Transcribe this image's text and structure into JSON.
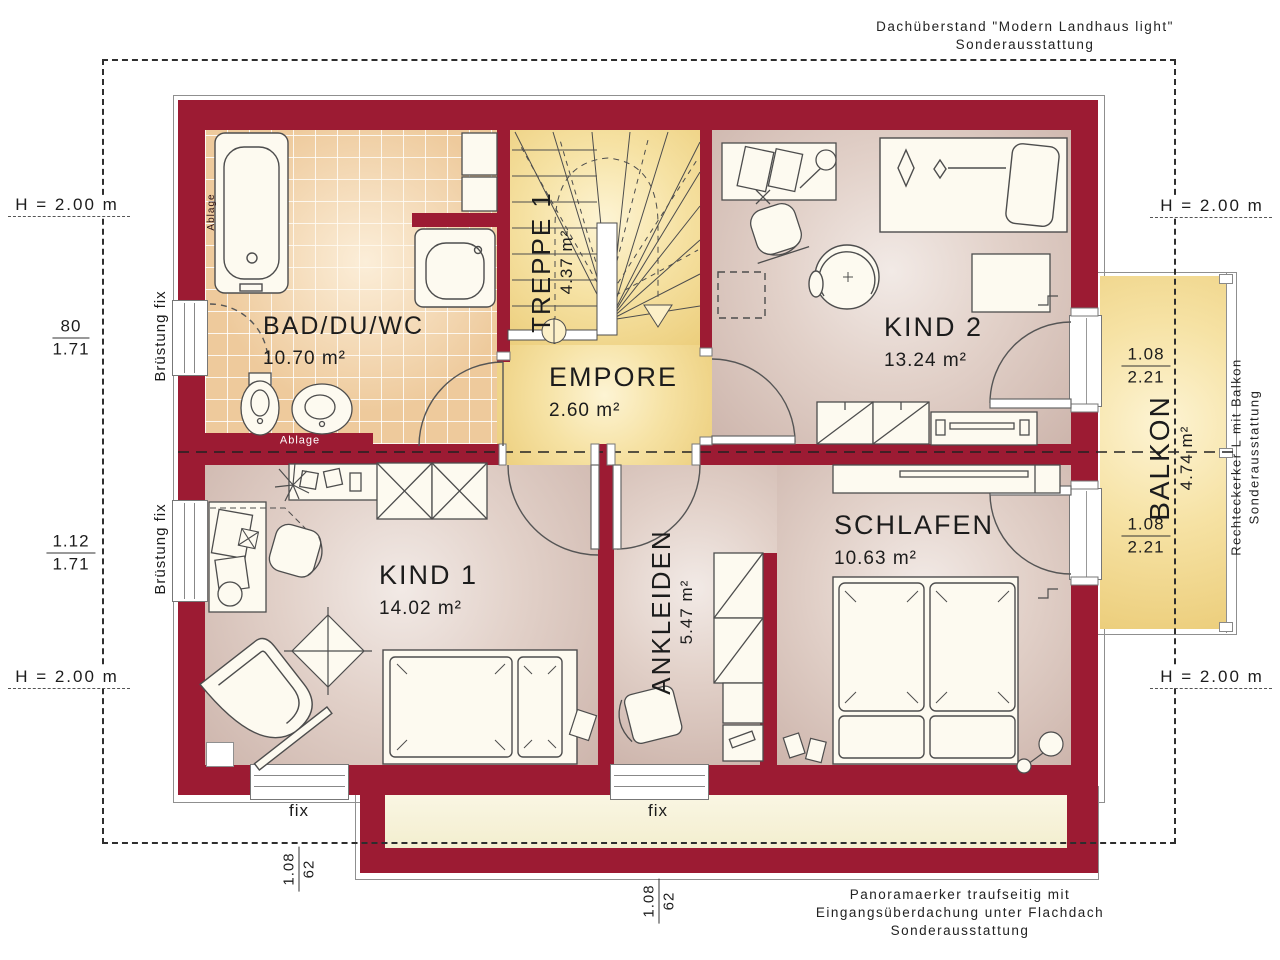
{
  "annotations": {
    "top_right_line1": "Dachüberstand \"Modern Landhaus light\"",
    "top_right_line2": "Sonderausstattung",
    "balcony_line1": "Rechteckerker L mit Balkon",
    "balcony_line2": "Sonderausstattung",
    "bottom_line1": "Panoramaerker traufseitig mit",
    "bottom_line2": "Eingangsüberdachung unter Flachdach",
    "bottom_line3": "Sonderausstattung"
  },
  "rooms": {
    "bad": {
      "name": "BAD/DU/WC",
      "area": "10.70 m²"
    },
    "treppe": {
      "name": "TREPPE 1",
      "area": "4.37 m²"
    },
    "empore": {
      "name": "EMPORE",
      "area": "2.60 m²"
    },
    "kind2": {
      "name": "KIND 2",
      "area": "13.24 m²"
    },
    "kind1": {
      "name": "KIND 1",
      "area": "14.02 m²"
    },
    "ankleiden": {
      "name": "ANKLEIDEN",
      "area": "5.47 m²"
    },
    "schlafen": {
      "name": "SCHLAFEN",
      "area": "10.63 m²"
    },
    "balkon": {
      "name": "BALKON",
      "area": "4.74 m²"
    }
  },
  "dimensions": {
    "h_top_left": "H = 2.00 m",
    "h_bottom_left": "H = 2.00 m",
    "h_top_right": "H = 2.00 m",
    "h_bottom_right": "H = 2.00 m",
    "frac_left_top": {
      "num": "80",
      "den": "1.71"
    },
    "frac_left_bottom": {
      "num": "1.12",
      "den": "1.71"
    },
    "frac_balcony_top": {
      "num": "1.08",
      "den": "2.21"
    },
    "frac_balcony_bottom": {
      "num": "1.08",
      "den": "2.21"
    },
    "frac_bay_left": {
      "num": "1.08",
      "den": "62"
    },
    "frac_bay_mid": {
      "num": "1.08",
      "den": "62"
    }
  },
  "labels": {
    "bruestung_top": "Brüstung fix",
    "bruestung_bottom": "Brüstung fix",
    "fix_left": "fix",
    "fix_mid": "fix",
    "ablage_vertical": "Ablage",
    "ablage_shelf": "Ablage"
  },
  "colors": {
    "wall_red": "#9c1b33",
    "floor_warm": "#d9c2ba",
    "floor_yellow": "#f2d78e",
    "tile": "#eeca9c",
    "bay_cream": "#f7f3dc"
  }
}
